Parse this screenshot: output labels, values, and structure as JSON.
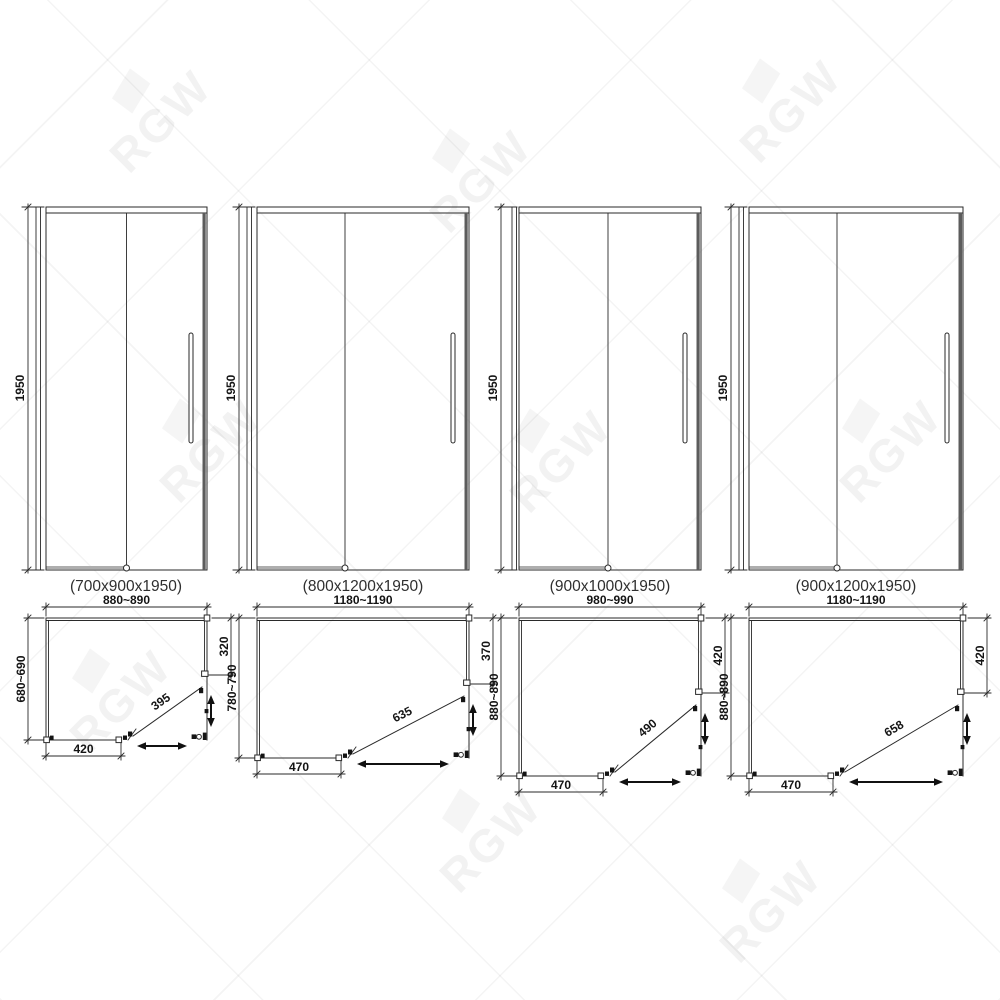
{
  "watermark": {
    "text": "RGW"
  },
  "doors": [
    {
      "caption": "(700x900x1950)",
      "height_label": "1950",
      "plan": {
        "width_label": "880~890",
        "depth_label": "680~690",
        "side_panel_label": "320",
        "door_leaf_label": "395",
        "wall_segment_label": "420"
      }
    },
    {
      "caption": "(800x1200x1950)",
      "height_label": "1950",
      "plan": {
        "width_label": "1180~1190",
        "depth_label": "780~790",
        "side_panel_label": "370",
        "door_leaf_label": "635",
        "wall_segment_label": "470"
      }
    },
    {
      "caption": "(900x1000x1950)",
      "height_label": "1950",
      "plan": {
        "width_label": "980~990",
        "depth_label": "880~890",
        "side_panel_label": "420",
        "door_leaf_label": "490",
        "wall_segment_label": "470"
      }
    },
    {
      "caption": "(900x1200x1950)",
      "height_label": "1950",
      "plan": {
        "width_label": "1180~1190",
        "depth_label": "880~890",
        "side_panel_label": "420",
        "door_leaf_label": "658",
        "wall_segment_label": "470"
      }
    }
  ]
}
